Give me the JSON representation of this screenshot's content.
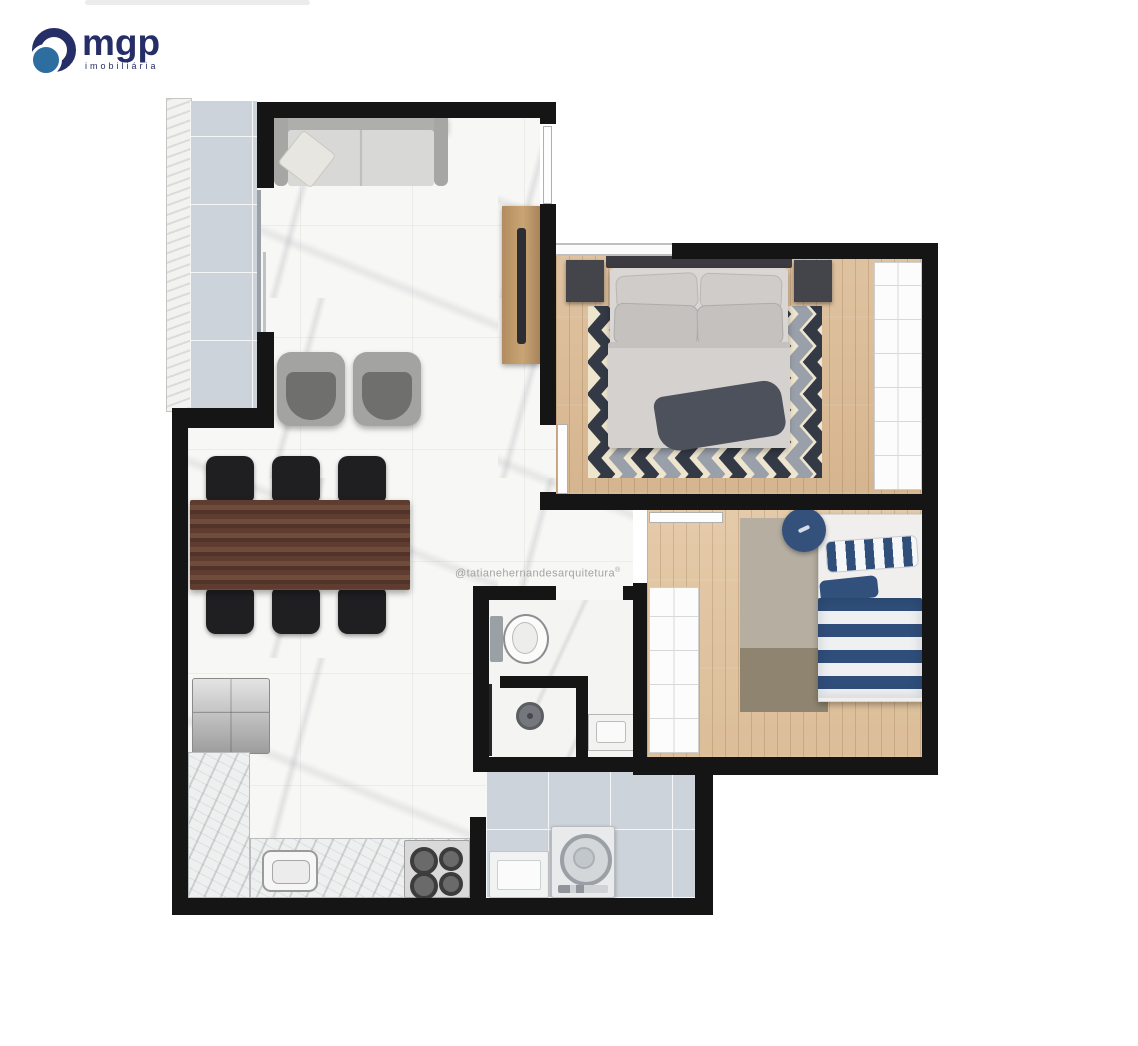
{
  "branding": {
    "logo_text": "mgp",
    "logo_subtext": "imobiliária",
    "logo_colors": {
      "ring_navy": "#252e66",
      "dot_blue": "#2d6da0"
    }
  },
  "watermark": {
    "text": "@tatianehernandesarquitetura",
    "mark": "®"
  },
  "palette": {
    "wall_black": "#151515",
    "marble_floor": "#f7f7f5",
    "wood_floor": "#dcbd98",
    "balcony_laundry_tile": "#cdd3da",
    "navy_bedding": "#2f4e79",
    "chevron_dark": "#343a45",
    "chevron_gray": "#9aa0aa",
    "chevron_cream": "#eee5cf",
    "dining_wood": "#5e3c30",
    "console_wood": "#b28c60"
  },
  "floorplan": {
    "type": "apartment-top-view-render",
    "rooms": [
      {
        "id": "balcony",
        "furniture": [
          "tile-floor",
          "ledge",
          "sliding-door"
        ]
      },
      {
        "id": "living-dining-kitchen",
        "furniture": [
          "sofa",
          "throw-pillow",
          "armchair",
          "armchair",
          "tv-console",
          "tv",
          "dining-table",
          "dining-chair-x6",
          "refrigerator",
          "l-shaped-counter",
          "kitchen-sink",
          "cooktop-4-burners"
        ]
      },
      {
        "id": "master-bedroom",
        "furniture": [
          "double-bed",
          "pillows-x4",
          "throw-blanket",
          "nightstand-x2",
          "chevron-rug",
          "wardrobe",
          "door-leaf"
        ]
      },
      {
        "id": "bedroom-2",
        "furniture": [
          "single-bed-striped",
          "striped-pillow",
          "round-pouf",
          "two-tone-rug",
          "wardrobe",
          "door-leaf"
        ]
      },
      {
        "id": "bathroom",
        "furniture": [
          "toilet",
          "shower-stall",
          "shower-drain",
          "vanity-sink"
        ]
      },
      {
        "id": "laundry",
        "furniture": [
          "laundry-tub",
          "washing-machine"
        ]
      }
    ]
  }
}
